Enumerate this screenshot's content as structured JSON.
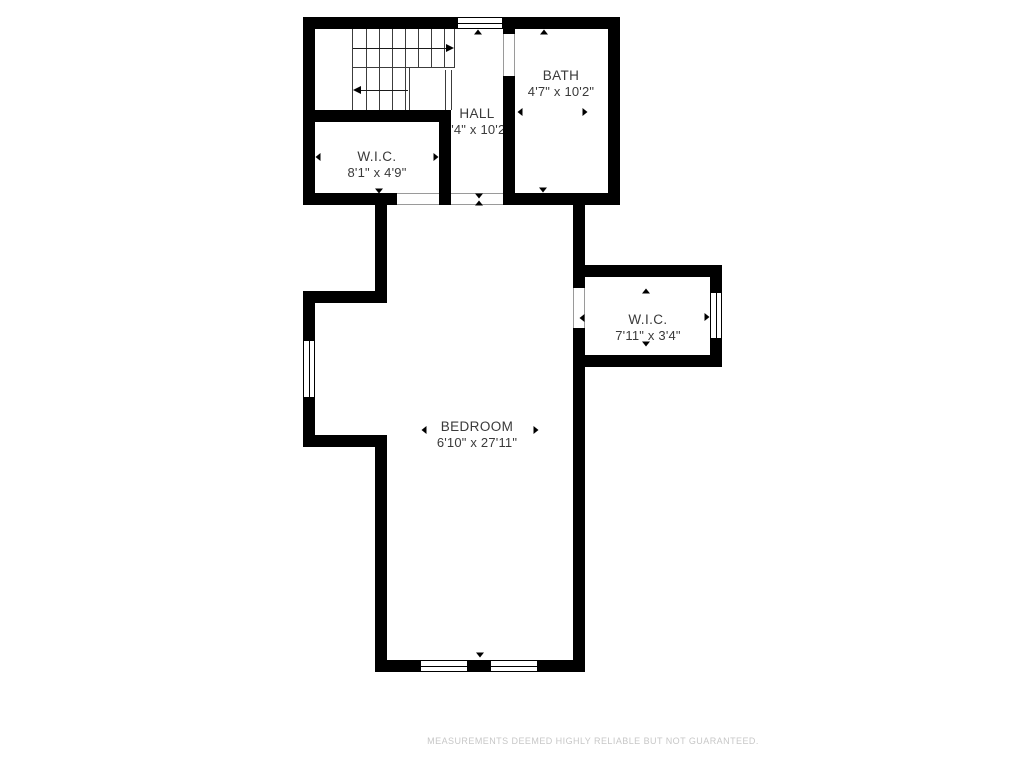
{
  "page": {
    "background_color": "#ffffff",
    "wall_color": "#000000",
    "label_color": "#3a3a3a",
    "disclaimer_color": "#c7c7c7"
  },
  "floorplan": {
    "rooms": [
      {
        "id": "wic-upper",
        "name": "W.I.C.",
        "dimensions": "8'1\" x 4'9\""
      },
      {
        "id": "hall",
        "name": "HALL",
        "dimensions": "3'4\" x 10'2\""
      },
      {
        "id": "bath",
        "name": "BATH",
        "dimensions": "4'7\" x 10'2\""
      },
      {
        "id": "bedroom",
        "name": "BEDROOM",
        "dimensions": "6'10\" x 27'11\""
      },
      {
        "id": "wic-right",
        "name": "W.I.C.",
        "dimensions": "7'11\" x 3'4\""
      }
    ],
    "disclaimer": "MEASUREMENTS DEEMED HIGHLY RELIABLE BUT NOT GUARANTEED."
  }
}
